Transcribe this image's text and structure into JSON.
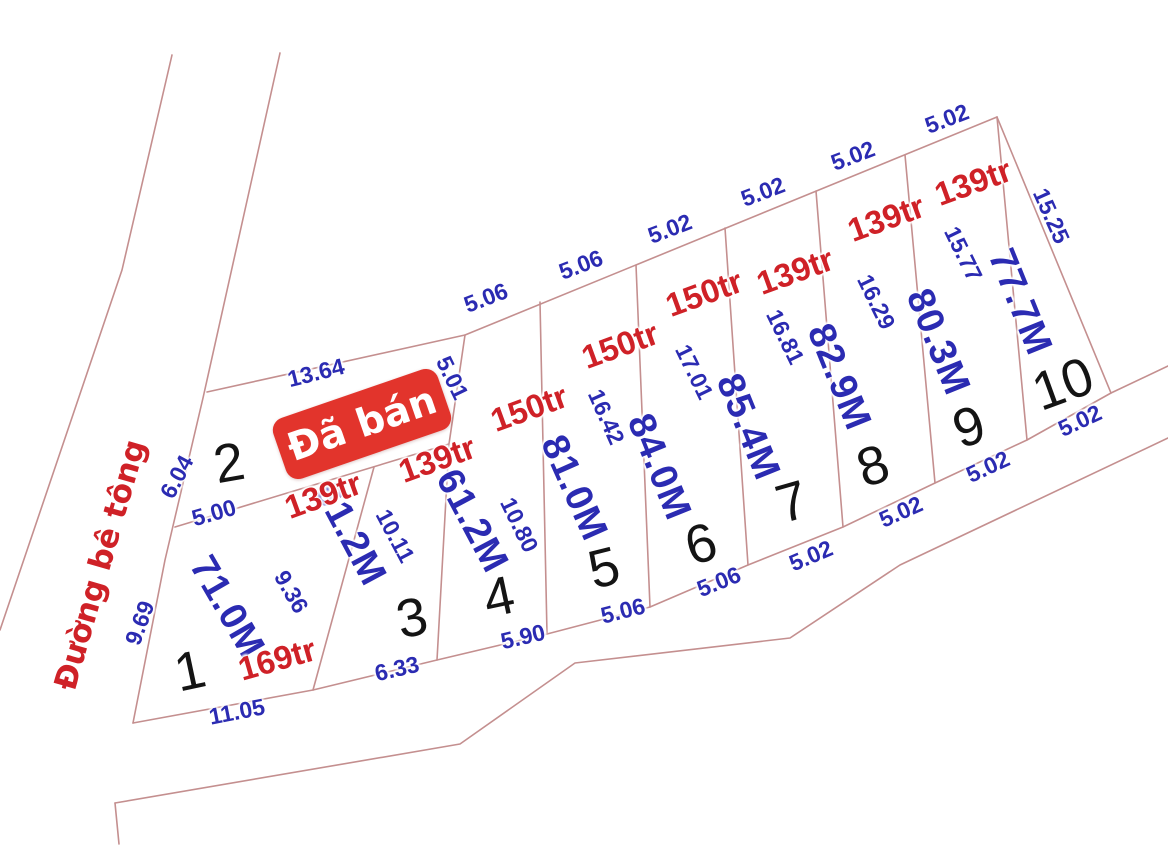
{
  "road": {
    "label": "Đường bê tông"
  },
  "badge": {
    "label": "Đã bán"
  },
  "plots": [
    {
      "number": "1",
      "area": "71.0M",
      "price": "169tr"
    },
    {
      "number": "2",
      "sold": true
    },
    {
      "number": "3",
      "area": "61.2M",
      "price": "139tr"
    },
    {
      "number": "4",
      "area": "61.2M",
      "price": "139tr"
    },
    {
      "number": "5",
      "area": "81.0M",
      "price": "150tr"
    },
    {
      "number": "6",
      "area": "84.0M",
      "price": "150tr"
    },
    {
      "number": "7",
      "area": "85.4M",
      "price": "150tr"
    },
    {
      "number": "8",
      "area": "82.9M",
      "price": "139tr"
    },
    {
      "number": "9",
      "area": "80.3M",
      "price": "139tr"
    },
    {
      "number": "10",
      "area": "77.7M",
      "price": "139tr"
    }
  ],
  "dims": {
    "top": [
      "13.64",
      "5.01",
      "5.06",
      "5.06",
      "5.02",
      "5.02",
      "5.02",
      "5.02"
    ],
    "right": [
      "15.25"
    ],
    "front": [
      "11.05",
      "6.33",
      "5.90",
      "5.06",
      "5.06",
      "5.02",
      "5.02",
      "5.02",
      "5.02"
    ],
    "left": [
      "6.04",
      "9.69",
      "5.00"
    ],
    "sep": [
      "9.36",
      "10.11",
      "10.80",
      "16.42",
      "17.01",
      "16.81",
      "16.29",
      "15.77"
    ]
  },
  "colors": {
    "line": "#c48f8f",
    "dimension": "#2b2bb2",
    "area": "#2b2bb2",
    "price": "#cf2127",
    "number": "#141414",
    "road_label": "#cf2127",
    "badge_bg": "#e2342c",
    "badge_text": "#ffffff"
  }
}
